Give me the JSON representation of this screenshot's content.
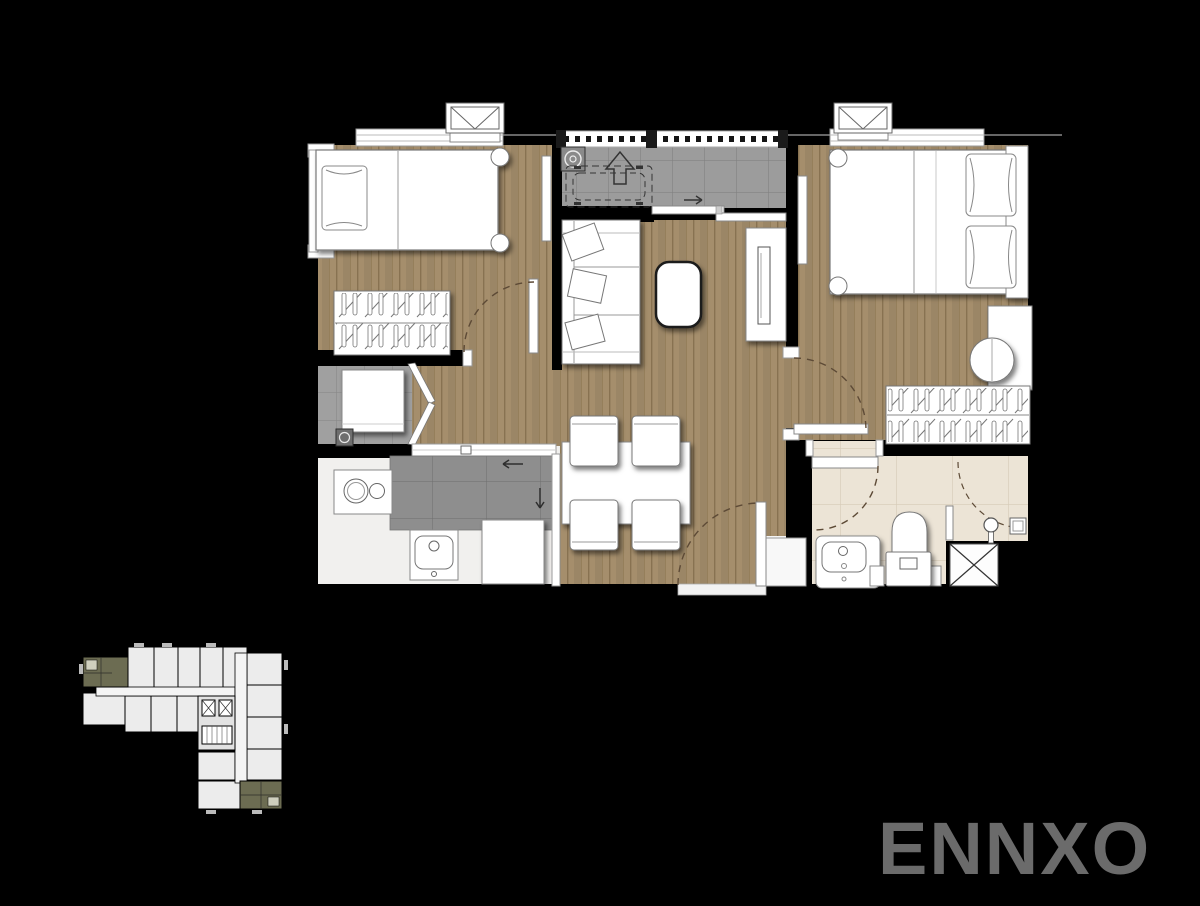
{
  "meta": {
    "description": "Two-bedroom condominium unit floor plan rendered on a black background, with bedrooms, living-dining area, kitchen, bathroom, utility closet and balcony; a small building key plan at lower left highlights two units; brand watermark at lower right."
  },
  "watermark": {
    "text": "ENNXO",
    "color": "#6b6b6b"
  },
  "colors": {
    "background": "#000000",
    "wood_floor": "#a58e6c",
    "wood_line": "#826d4c",
    "balcony_tile": "#9c9c9c",
    "utility_tile": "#a0a0a0",
    "counter_top": "#8e8e8e",
    "bathroom_tile": "#ece4d6",
    "kitchen_floor": "#f1f0ee",
    "furniture": "#ffffff",
    "wall": "#000000",
    "door_arc": "#5d4a36",
    "keyplan_unit": "#ececec",
    "keyplan_highlight": "#6c6c52"
  },
  "keyplan": {
    "highlighted_units": 2
  }
}
